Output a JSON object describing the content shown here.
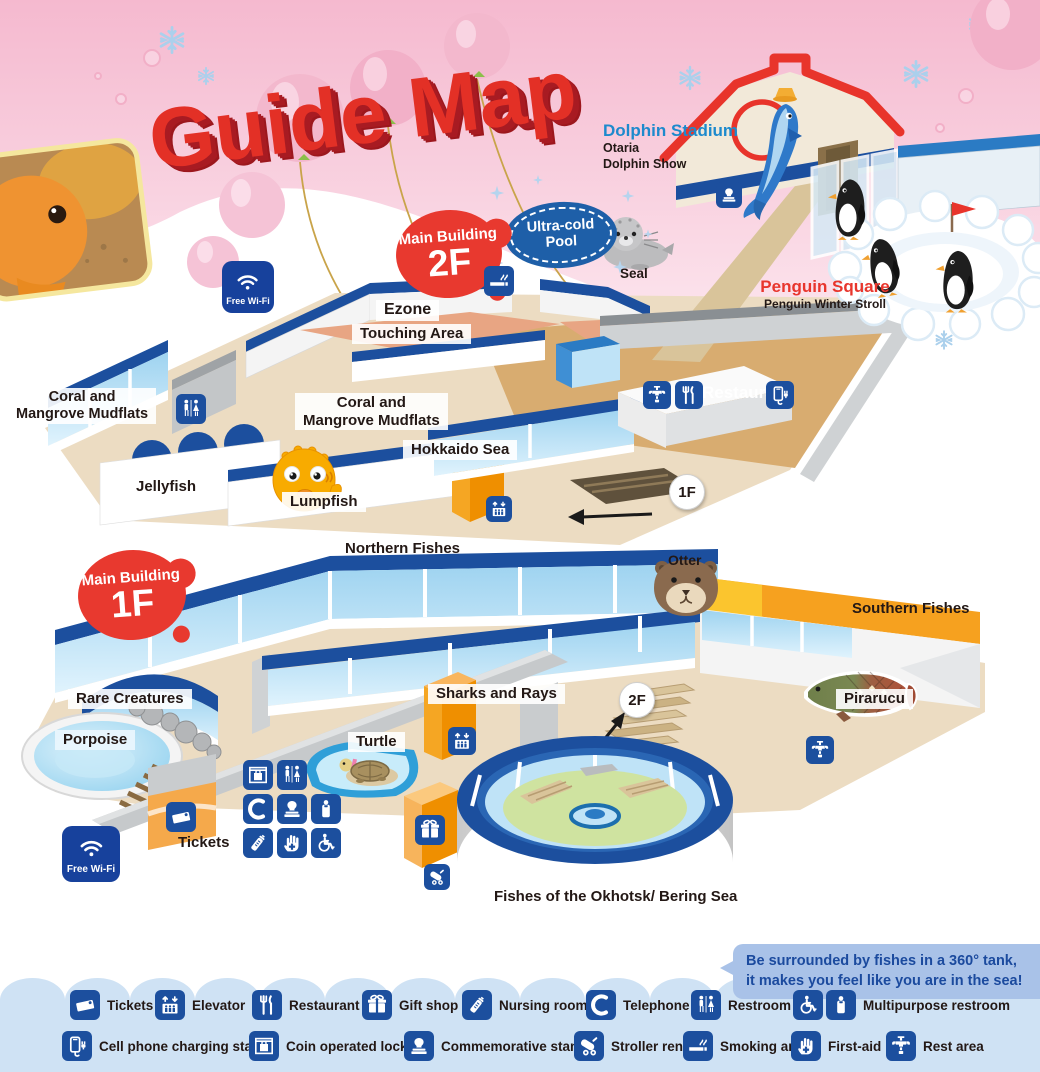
{
  "title": "Guide Map",
  "wifi_label": "Free Wi-Fi",
  "stadium": {
    "title": "Dolphin Stadium",
    "sub1": "Otaria",
    "sub2": "Dolphin Show"
  },
  "ultra_cold": {
    "line1": "Ultra-cold",
    "line2": "Pool",
    "seal": "Seal"
  },
  "penguin": {
    "title": "Penguin Square",
    "sub": "Penguin Winter Stroll"
  },
  "f2": {
    "badge_name": "Main Building",
    "badge_floor": "2F",
    "ezone": "Ezone",
    "touching": "Touching Area",
    "coral1": "Coral and",
    "coral2": "Mangrove Mudflats",
    "hokkaido": "Hokkaido Sea",
    "jellyfish": "Jellyfish",
    "lumpfish": "Lumpfish",
    "restaurant": "Restaurant",
    "to_1f": "1F"
  },
  "f1": {
    "badge_name": "Main Building",
    "badge_floor": "1F",
    "northern": "Northern Fishes",
    "otter": "Otter",
    "southern": "Southern Fishes",
    "pirarucu": "Pirarucu",
    "rare": "Rare Creatures",
    "porpoise": "Porpoise",
    "sharks": "Sharks and Rays",
    "turtle": "Turtle",
    "tickets": "Tickets",
    "to_2f": "2F",
    "okhotsk": "Fishes of the Okhotsk/ Bering Sea"
  },
  "callout": {
    "line1": "Be surrounded by fishes in a 360° tank,",
    "line2": "it makes you feel like you are in the sea!"
  },
  "legend": {
    "items": [
      {
        "icon": "tickets",
        "label": "Tickets"
      },
      {
        "icon": "elevator",
        "label": "Elevator"
      },
      {
        "icon": "restaurant",
        "label": "Restaurant"
      },
      {
        "icon": "gift",
        "label": "Gift shop"
      },
      {
        "icon": "nursing",
        "label": "Nursing room"
      },
      {
        "icon": "telephone",
        "label": "Telephone"
      },
      {
        "icon": "restroom",
        "label": "Restroom"
      },
      {
        "icon": "wheelchair+mpbag",
        "label": "Multipurpose restroom"
      },
      {
        "icon": "charging",
        "label": "Cell phone charging station"
      },
      {
        "icon": "lockers",
        "label": "Coin operated lockers"
      },
      {
        "icon": "stamp",
        "label": "Commemorative stamp"
      },
      {
        "icon": "stroller",
        "label": "Stroller rental"
      },
      {
        "icon": "smoking",
        "label": "Smoking area"
      },
      {
        "icon": "firstaid",
        "label": "First-aid"
      },
      {
        "icon": "restarea",
        "label": "Rest area"
      }
    ]
  },
  "colors": {
    "accent_red": "#e8362d",
    "icon_blue": "#1c4f9e",
    "stadium_label_blue": "#1d8acd",
    "legend_bg": "#cfe2f4",
    "floor_beige": "#ecdcc2",
    "orange": "#f39800"
  }
}
